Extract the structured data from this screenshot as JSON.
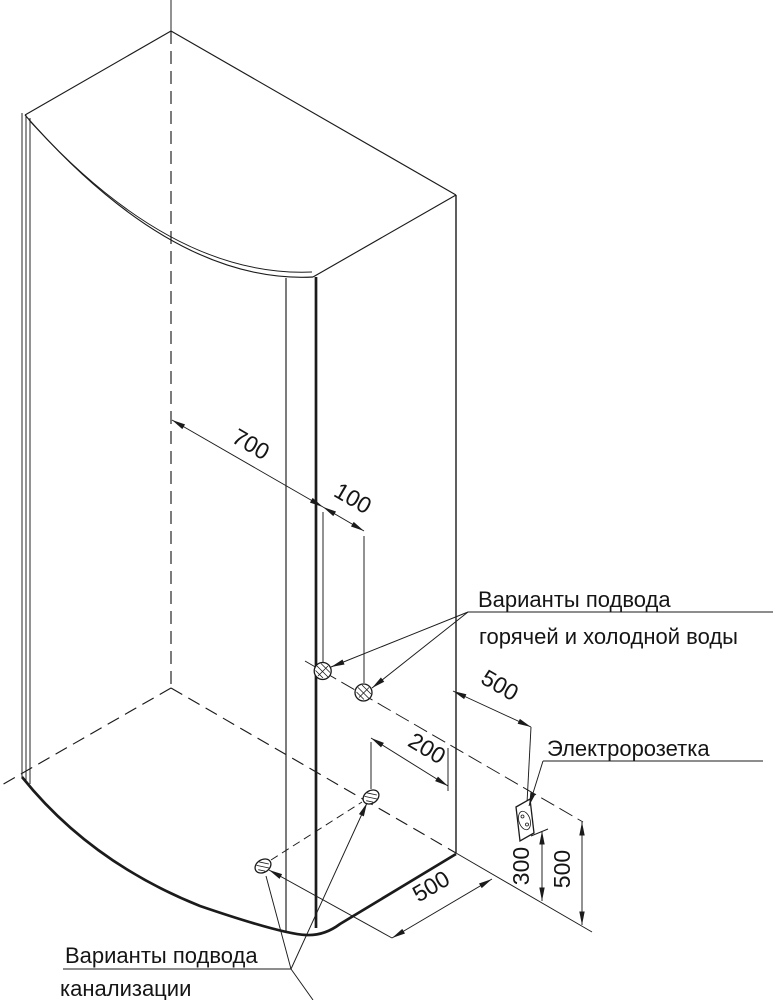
{
  "drawing": {
    "type": "shower-cabin installation diagram (isometric)",
    "colors": {
      "line": "#1b1b1b",
      "background": "#ffffff"
    },
    "dimensions": {
      "wall_700": "700",
      "wall_100": "100",
      "wall_500": "500",
      "floor_200": "200",
      "floor_500": "500",
      "height_300": "300",
      "height_500": "500"
    },
    "labels": {
      "water_supply_line1": "Варианты подвода",
      "water_supply_line2": "горячей и холодной воды",
      "socket": "Электророзетка",
      "drain_line1": "Варианты подвода",
      "drain_line2": "канализации"
    }
  }
}
